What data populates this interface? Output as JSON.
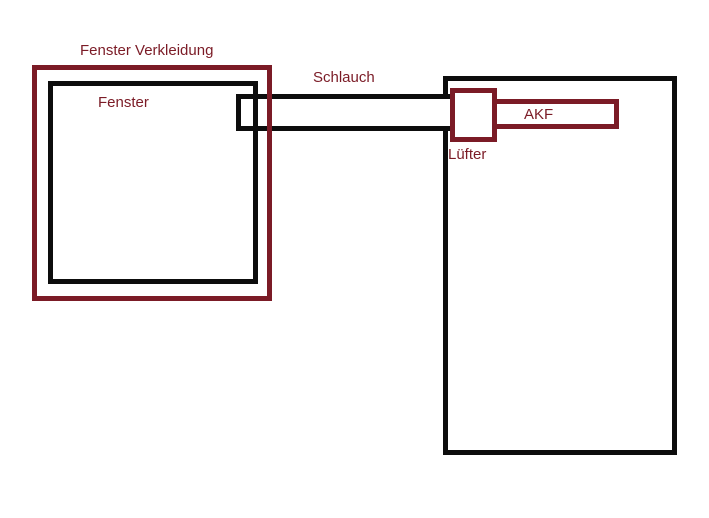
{
  "diagram": {
    "title": "Window fan ventilation schematic",
    "colors": {
      "accent_red": "#7b1b26",
      "line_black": "#0d0d0d",
      "background": "#ffffff"
    },
    "labels": {
      "verkleidung": "Fenster Verkleidung",
      "fenster": "Fenster",
      "schlauch": "Schlauch",
      "luefter": "Lüfter",
      "akf": "AKF"
    }
  }
}
